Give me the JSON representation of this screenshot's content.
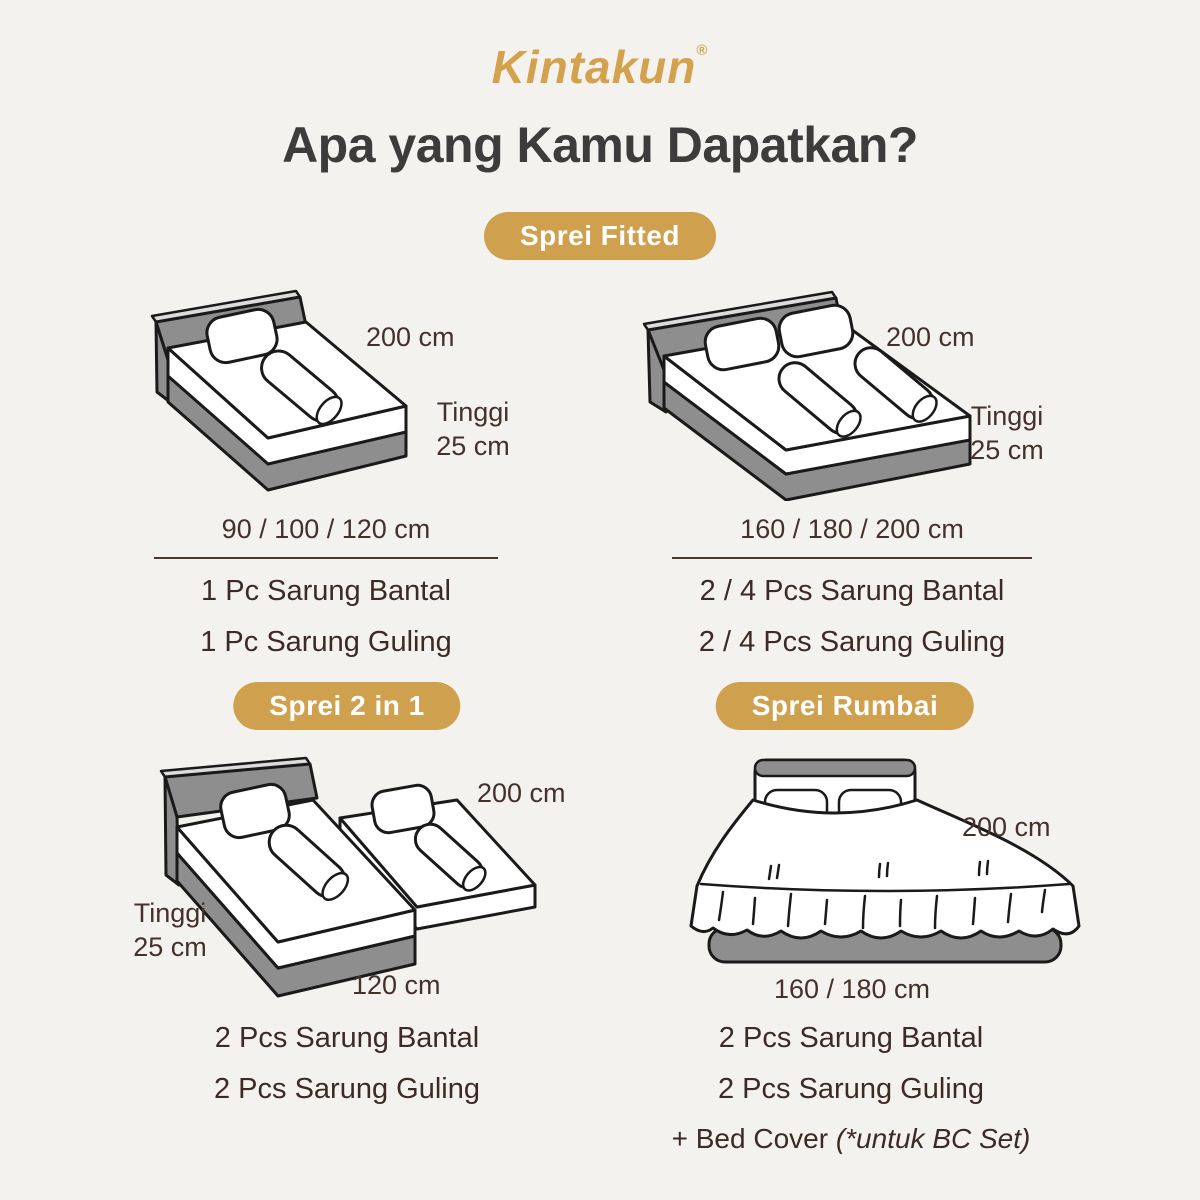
{
  "brand": {
    "name": "Kintakun",
    "registered": "®"
  },
  "title": "Apa yang Kamu Dapatkan?",
  "colors": {
    "background": "#f4f2ef",
    "gold_badge": "#cfa04e",
    "logo_gold": "#d4a24c",
    "title_gray": "#3d3b3c",
    "text_brown": "#43312a",
    "bed_frame_gray": "#8e8e8e",
    "outline_black": "#1a1a1a"
  },
  "sections": {
    "sprei_fitted": {
      "badge": "Sprei Fitted",
      "single": {
        "length_label": "200 cm",
        "height_label_line1": "Tinggi",
        "height_label_line2": "25 cm",
        "sizes": "90 / 100 / 120 cm",
        "items": [
          "1 Pc Sarung Bantal",
          "1 Pc Sarung Guling"
        ]
      },
      "double": {
        "length_label": "200 cm",
        "height_label_line1": "Tinggi",
        "height_label_line2": "25 cm",
        "sizes": "160 / 180 / 200 cm",
        "items": [
          "2 / 4 Pcs Sarung Bantal",
          "2 / 4 Pcs Sarung Guling"
        ]
      }
    },
    "sprei_2in1": {
      "badge": "Sprei 2 in 1",
      "length_label": "200 cm",
      "height_label_line1": "Tinggi",
      "height_label_line2": "25 cm",
      "width_label": "120 cm",
      "items": [
        "2 Pcs Sarung Bantal",
        "2 Pcs Sarung Guling"
      ]
    },
    "sprei_rumbai": {
      "badge": "Sprei Rumbai",
      "length_label": "200 cm",
      "width_label": "160 / 180 cm",
      "items": [
        "2 Pcs Sarung Bantal",
        "2 Pcs Sarung Guling"
      ],
      "extra_item_prefix": "+ Bed Cover ",
      "extra_item_note": "(*untuk BC Set)"
    }
  }
}
